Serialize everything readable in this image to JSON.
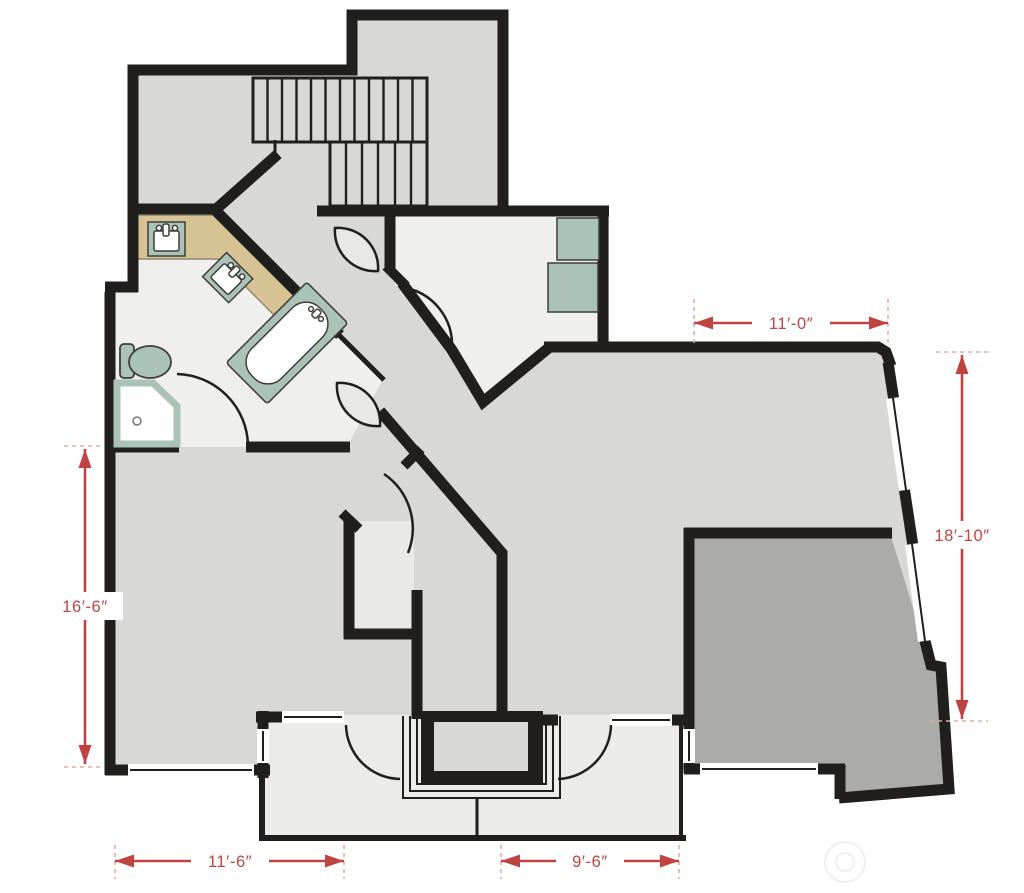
{
  "title": "second-floor-plan",
  "dimensions": [
    {
      "id": "upper-right-width",
      "label": "11′-0″",
      "orientation": "horizontal"
    },
    {
      "id": "right-height",
      "label": "18′-10″",
      "orientation": "vertical"
    },
    {
      "id": "left-height",
      "label": "16′-6″",
      "orientation": "vertical"
    },
    {
      "id": "bottom-left-width",
      "label": "11′-6″",
      "orientation": "horizontal"
    },
    {
      "id": "bottom-right-width",
      "label": "9′-6″",
      "orientation": "horizontal"
    }
  ],
  "colors": {
    "wall": "#201f1d",
    "floor_main": "#d8d8d7",
    "floor_light": "#efefee",
    "floor_deck": "#ebebea",
    "floor_dark": "#ababaa",
    "floor_closet": "#e9e9e8",
    "counter_tan": "#d7c393",
    "fixture_green": "#abc3b6",
    "fixture_outline": "#3d3d39",
    "dimension_red": "#bf4341",
    "extension_pink": "#e7aaa6",
    "window_white": "#ffffff",
    "door_leaf": "#e8e8e7",
    "watermark": "#efefef"
  },
  "fixtures": {
    "stairs": "staircase with two flights",
    "vanity": "double-sink vanity counter",
    "tub": "bathtub",
    "toilet": "toilet",
    "shower": "corner shower",
    "fireplace": "fireplace with hearth",
    "bedroom_units": "two built-in squares"
  }
}
